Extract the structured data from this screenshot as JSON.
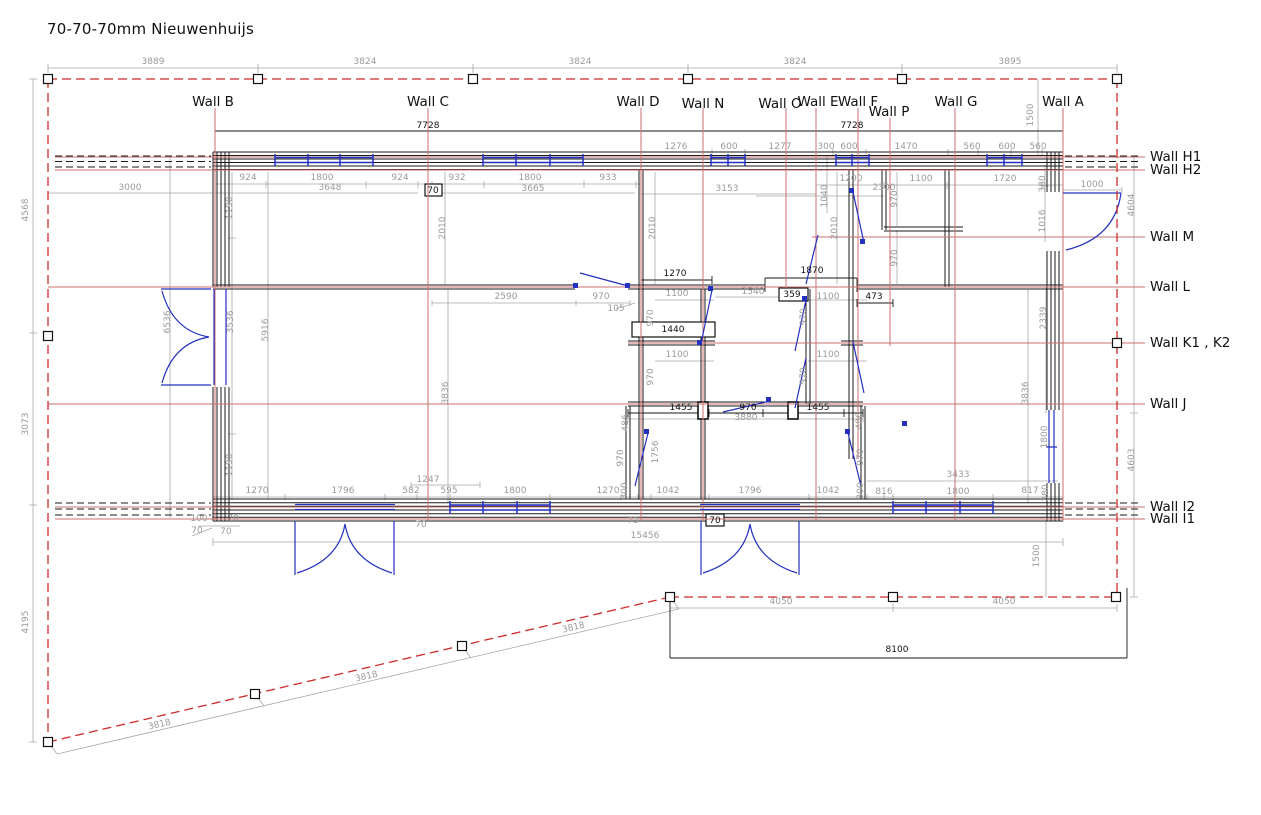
{
  "title": "70-70-70mm Nieuwenhuijs",
  "colors": {
    "boundary_red": "#cf2b2b",
    "axis_red": "#c97070",
    "dimension_gray": "#9a9a9a",
    "wall_black": "#1a1a1a",
    "door_blue": "#2330c0"
  },
  "plan": {
    "top_wall_labels": [
      {
        "label": "Wall B",
        "x": 213,
        "y": 106
      },
      {
        "label": "Wall C",
        "x": 428,
        "y": 106
      },
      {
        "label": "Wall D",
        "x": 638,
        "y": 106
      },
      {
        "label": "Wall N",
        "x": 703,
        "y": 108
      },
      {
        "label": "Wall O",
        "x": 780,
        "y": 108
      },
      {
        "label": "Wall E",
        "x": 818,
        "y": 106
      },
      {
        "label": "Wall F",
        "x": 858,
        "y": 106
      },
      {
        "label": "Wall P",
        "x": 889,
        "y": 116
      },
      {
        "label": "Wall G",
        "x": 956,
        "y": 106
      },
      {
        "label": "Wall A",
        "x": 1063,
        "y": 106
      }
    ],
    "right_wall_labels": [
      {
        "label": "Wall H1",
        "x": 1150,
        "y": 161
      },
      {
        "label": "Wall H2",
        "x": 1150,
        "y": 174
      },
      {
        "label": "Wall M",
        "x": 1150,
        "y": 241
      },
      {
        "label": "Wall L",
        "x": 1150,
        "y": 291
      },
      {
        "label": "Wall K1 , K2",
        "x": 1150,
        "y": 347
      },
      {
        "label": "Wall J",
        "x": 1150,
        "y": 408
      },
      {
        "label": "Wall I2",
        "x": 1150,
        "y": 511
      },
      {
        "label": "Wall I1",
        "x": 1150,
        "y": 523
      }
    ],
    "dim_labels": [
      {
        "t": "3889",
        "x": 153,
        "y": 64
      },
      {
        "t": "3824",
        "x": 365,
        "y": 64
      },
      {
        "t": "3824",
        "x": 580,
        "y": 64
      },
      {
        "t": "3824",
        "x": 795,
        "y": 64
      },
      {
        "t": "3895",
        "x": 1010,
        "y": 64
      },
      {
        "t": "7728",
        "x": 428,
        "y": 128,
        "c": "b"
      },
      {
        "t": "7728",
        "x": 852,
        "y": 128,
        "c": "b"
      },
      {
        "t": "1276",
        "x": 676,
        "y": 149
      },
      {
        "t": "600",
        "x": 729,
        "y": 149
      },
      {
        "t": "1277",
        "x": 780,
        "y": 149
      },
      {
        "t": "300",
        "x": 826,
        "y": 149
      },
      {
        "t": "600",
        "x": 849,
        "y": 149
      },
      {
        "t": "1470",
        "x": 906,
        "y": 149
      },
      {
        "t": "560",
        "x": 972,
        "y": 149
      },
      {
        "t": "600",
        "x": 1007,
        "y": 149
      },
      {
        "t": "560",
        "x": 1038,
        "y": 149
      },
      {
        "t": "924",
        "x": 248,
        "y": 180
      },
      {
        "t": "1800",
        "x": 322,
        "y": 180
      },
      {
        "t": "924",
        "x": 400,
        "y": 180
      },
      {
        "t": "932",
        "x": 457,
        "y": 180
      },
      {
        "t": "1800",
        "x": 530,
        "y": 180
      },
      {
        "t": "933",
        "x": 608,
        "y": 180
      },
      {
        "t": "1200",
        "x": 851,
        "y": 181
      },
      {
        "t": "1100",
        "x": 921,
        "y": 181
      },
      {
        "t": "1720",
        "x": 1005,
        "y": 181
      },
      {
        "t": "3000",
        "x": 130,
        "y": 190
      },
      {
        "t": "3648",
        "x": 330,
        "y": 190
      },
      {
        "t": "70",
        "x": 433,
        "y": 193,
        "c": "b"
      },
      {
        "t": "3665",
        "x": 533,
        "y": 191
      },
      {
        "t": "3153",
        "x": 727,
        "y": 191
      },
      {
        "t": "2300",
        "x": 884,
        "y": 190
      },
      {
        "t": "1000",
        "x": 1092,
        "y": 187
      },
      {
        "t": "1500",
        "x": 1033,
        "y": 115,
        "r": -90
      },
      {
        "t": "4568",
        "x": 28,
        "y": 210,
        "r": -90
      },
      {
        "t": "3073",
        "x": 28,
        "y": 424,
        "r": -90
      },
      {
        "t": "4195",
        "x": 28,
        "y": 622,
        "r": -90
      },
      {
        "t": "1190",
        "x": 232,
        "y": 208,
        "r": -90
      },
      {
        "t": "6536",
        "x": 170,
        "y": 322,
        "r": -90
      },
      {
        "t": "3536",
        "x": 233,
        "y": 322,
        "r": -90
      },
      {
        "t": "5916",
        "x": 268,
        "y": 330,
        "r": -90
      },
      {
        "t": "1190",
        "x": 232,
        "y": 465,
        "r": -90
      },
      {
        "t": "2010",
        "x": 445,
        "y": 228,
        "r": -90
      },
      {
        "t": "2010",
        "x": 655,
        "y": 228,
        "r": -90
      },
      {
        "t": "1040",
        "x": 827,
        "y": 196,
        "r": -90
      },
      {
        "t": "2010",
        "x": 837,
        "y": 228,
        "r": -90
      },
      {
        "t": "970",
        "x": 897,
        "y": 199,
        "r": -90
      },
      {
        "t": "970",
        "x": 897,
        "y": 258,
        "r": -90
      },
      {
        "t": "380",
        "x": 1045,
        "y": 184,
        "r": -90
      },
      {
        "t": "1016",
        "x": 1045,
        "y": 221,
        "r": -90
      },
      {
        "t": "4604",
        "x": 1134,
        "y": 205,
        "r": -90
      },
      {
        "t": "2339",
        "x": 1046,
        "y": 318,
        "r": -90
      },
      {
        "t": "3836",
        "x": 448,
        "y": 393,
        "r": -90
      },
      {
        "t": "3836",
        "x": 1028,
        "y": 393,
        "r": -90
      },
      {
        "t": "4603",
        "x": 1134,
        "y": 460,
        "r": -90
      },
      {
        "t": "1800",
        "x": 1047,
        "y": 437,
        "r": -90
      },
      {
        "t": "2590",
        "x": 506,
        "y": 299
      },
      {
        "t": "970",
        "x": 601,
        "y": 299
      },
      {
        "t": "105",
        "x": 616,
        "y": 311
      },
      {
        "t": "1270",
        "x": 675,
        "y": 276,
        "c": "b"
      },
      {
        "t": "1100",
        "x": 677,
        "y": 296
      },
      {
        "t": "970",
        "x": 653,
        "y": 318,
        "r": -90
      },
      {
        "t": "1440",
        "x": 673,
        "y": 332,
        "c": "b"
      },
      {
        "t": "1100",
        "x": 677,
        "y": 357
      },
      {
        "t": "970",
        "x": 653,
        "y": 377,
        "r": -90
      },
      {
        "t": "1540",
        "x": 753,
        "y": 294
      },
      {
        "t": "359",
        "x": 792,
        "y": 297,
        "c": "b"
      },
      {
        "t": "1870",
        "x": 812,
        "y": 273,
        "c": "b"
      },
      {
        "t": "473",
        "x": 874,
        "y": 299,
        "c": "b"
      },
      {
        "t": "1100",
        "x": 828,
        "y": 299
      },
      {
        "t": "970",
        "x": 806,
        "y": 317,
        "r": -90
      },
      {
        "t": "1100",
        "x": 828,
        "y": 357
      },
      {
        "t": "970",
        "x": 806,
        "y": 376,
        "r": -90
      },
      {
        "t": "1455",
        "x": 681,
        "y": 410,
        "c": "b"
      },
      {
        "t": "970",
        "x": 748,
        "y": 410,
        "c": "b"
      },
      {
        "t": "1455",
        "x": 818,
        "y": 410,
        "c": "b"
      },
      {
        "t": "3880",
        "x": 746,
        "y": 420
      },
      {
        "t": "486",
        "x": 628,
        "y": 423,
        "r": -90
      },
      {
        "t": "486",
        "x": 862,
        "y": 421,
        "r": -90
      },
      {
        "t": "970",
        "x": 623,
        "y": 458,
        "r": -90
      },
      {
        "t": "970",
        "x": 863,
        "y": 457,
        "r": -90
      },
      {
        "t": "1756",
        "x": 658,
        "y": 452,
        "r": -90
      },
      {
        "t": "300",
        "x": 627,
        "y": 491,
        "r": -90
      },
      {
        "t": "300",
        "x": 863,
        "y": 491,
        "r": -90
      },
      {
        "t": "380",
        "x": 1048,
        "y": 493,
        "r": -90
      },
      {
        "t": "1270",
        "x": 257,
        "y": 493
      },
      {
        "t": "1796",
        "x": 343,
        "y": 493
      },
      {
        "t": "582",
        "x": 411,
        "y": 493
      },
      {
        "t": "595",
        "x": 449,
        "y": 493
      },
      {
        "t": "1800",
        "x": 515,
        "y": 493
      },
      {
        "t": "1270",
        "x": 608,
        "y": 493
      },
      {
        "t": "1042",
        "x": 668,
        "y": 493
      },
      {
        "t": "1796",
        "x": 750,
        "y": 493
      },
      {
        "t": "1042",
        "x": 828,
        "y": 493
      },
      {
        "t": "816",
        "x": 884,
        "y": 494
      },
      {
        "t": "1800",
        "x": 958,
        "y": 494
      },
      {
        "t": "817",
        "x": 1030,
        "y": 493
      },
      {
        "t": "1247",
        "x": 428,
        "y": 482
      },
      {
        "t": "3433",
        "x": 958,
        "y": 477
      },
      {
        "t": "100",
        "x": 199,
        "y": 521
      },
      {
        "t": "70",
        "x": 233,
        "y": 521
      },
      {
        "t": "70",
        "x": 197,
        "y": 533
      },
      {
        "t": "70",
        "x": 226,
        "y": 534
      },
      {
        "t": "70",
        "x": 421,
        "y": 527
      },
      {
        "t": "70",
        "x": 715,
        "y": 523,
        "c": "b"
      },
      {
        "t": "75",
        "x": 633,
        "y": 523
      },
      {
        "t": "15456",
        "x": 645,
        "y": 538
      },
      {
        "t": "4050",
        "x": 781,
        "y": 604
      },
      {
        "t": "4050",
        "x": 1004,
        "y": 604
      },
      {
        "t": "8100",
        "x": 897,
        "y": 652,
        "c": "b"
      },
      {
        "t": "1500",
        "x": 1039,
        "y": 556,
        "r": -90
      },
      {
        "t": "3818",
        "x": 160,
        "y": 727,
        "r": -13
      },
      {
        "t": "3818",
        "x": 367,
        "y": 679,
        "r": -13
      },
      {
        "t": "3818",
        "x": 574,
        "y": 630,
        "r": -13
      }
    ]
  }
}
